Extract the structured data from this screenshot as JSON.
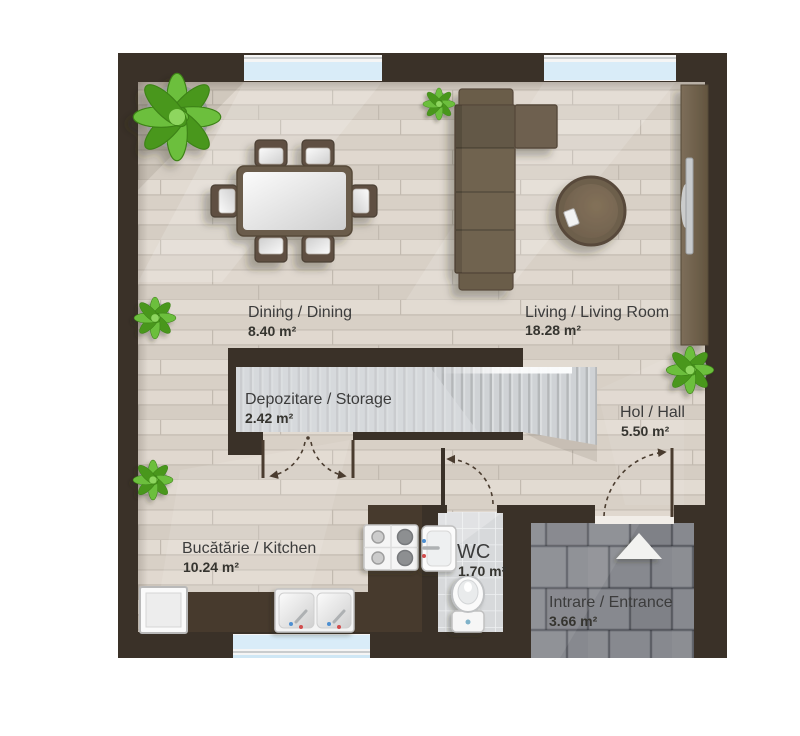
{
  "plan": {
    "rooms": [
      {
        "key": "dining",
        "label": "Dining / Dining",
        "area": "8.40 m²"
      },
      {
        "key": "living",
        "label": "Living / Living Room",
        "area": "18.28 m²"
      },
      {
        "key": "storage",
        "label": "Depozitare / Storage",
        "area": "2.42 m²"
      },
      {
        "key": "hall",
        "label": "Hol / Hall",
        "area": "5.50 m²"
      },
      {
        "key": "kitchen",
        "label": "Bucătărie / Kitchen",
        "area": "10.24 m²"
      },
      {
        "key": "wc",
        "label": "WC",
        "area": "1.70 m²"
      },
      {
        "key": "entrance",
        "label": "Intrare / Entrance",
        "area": "3.66 m²"
      }
    ],
    "furniture": [
      "dining-table",
      "dining-chairs-x6",
      "corner-sofa",
      "coffee-table",
      "tv-console",
      "staircase",
      "under-stair-storage",
      "kitchen-counter",
      "cooktop",
      "double-sink",
      "fridge",
      "wc-sink",
      "toilet",
      "potted-plants-x5",
      "entrance-arrow"
    ],
    "colors": {
      "wall": "#3a3128",
      "counter": "#473a2d",
      "floor": "#dcd4ca",
      "stairs": "#cfd2d5",
      "wc_tile": "#d7d9db",
      "paving": "#87898f",
      "window_glass": "#d9ecf8",
      "furniture_brown": "#70634f",
      "plant_green": "#5fae2e",
      "label_text": "#3c3c3c"
    }
  }
}
